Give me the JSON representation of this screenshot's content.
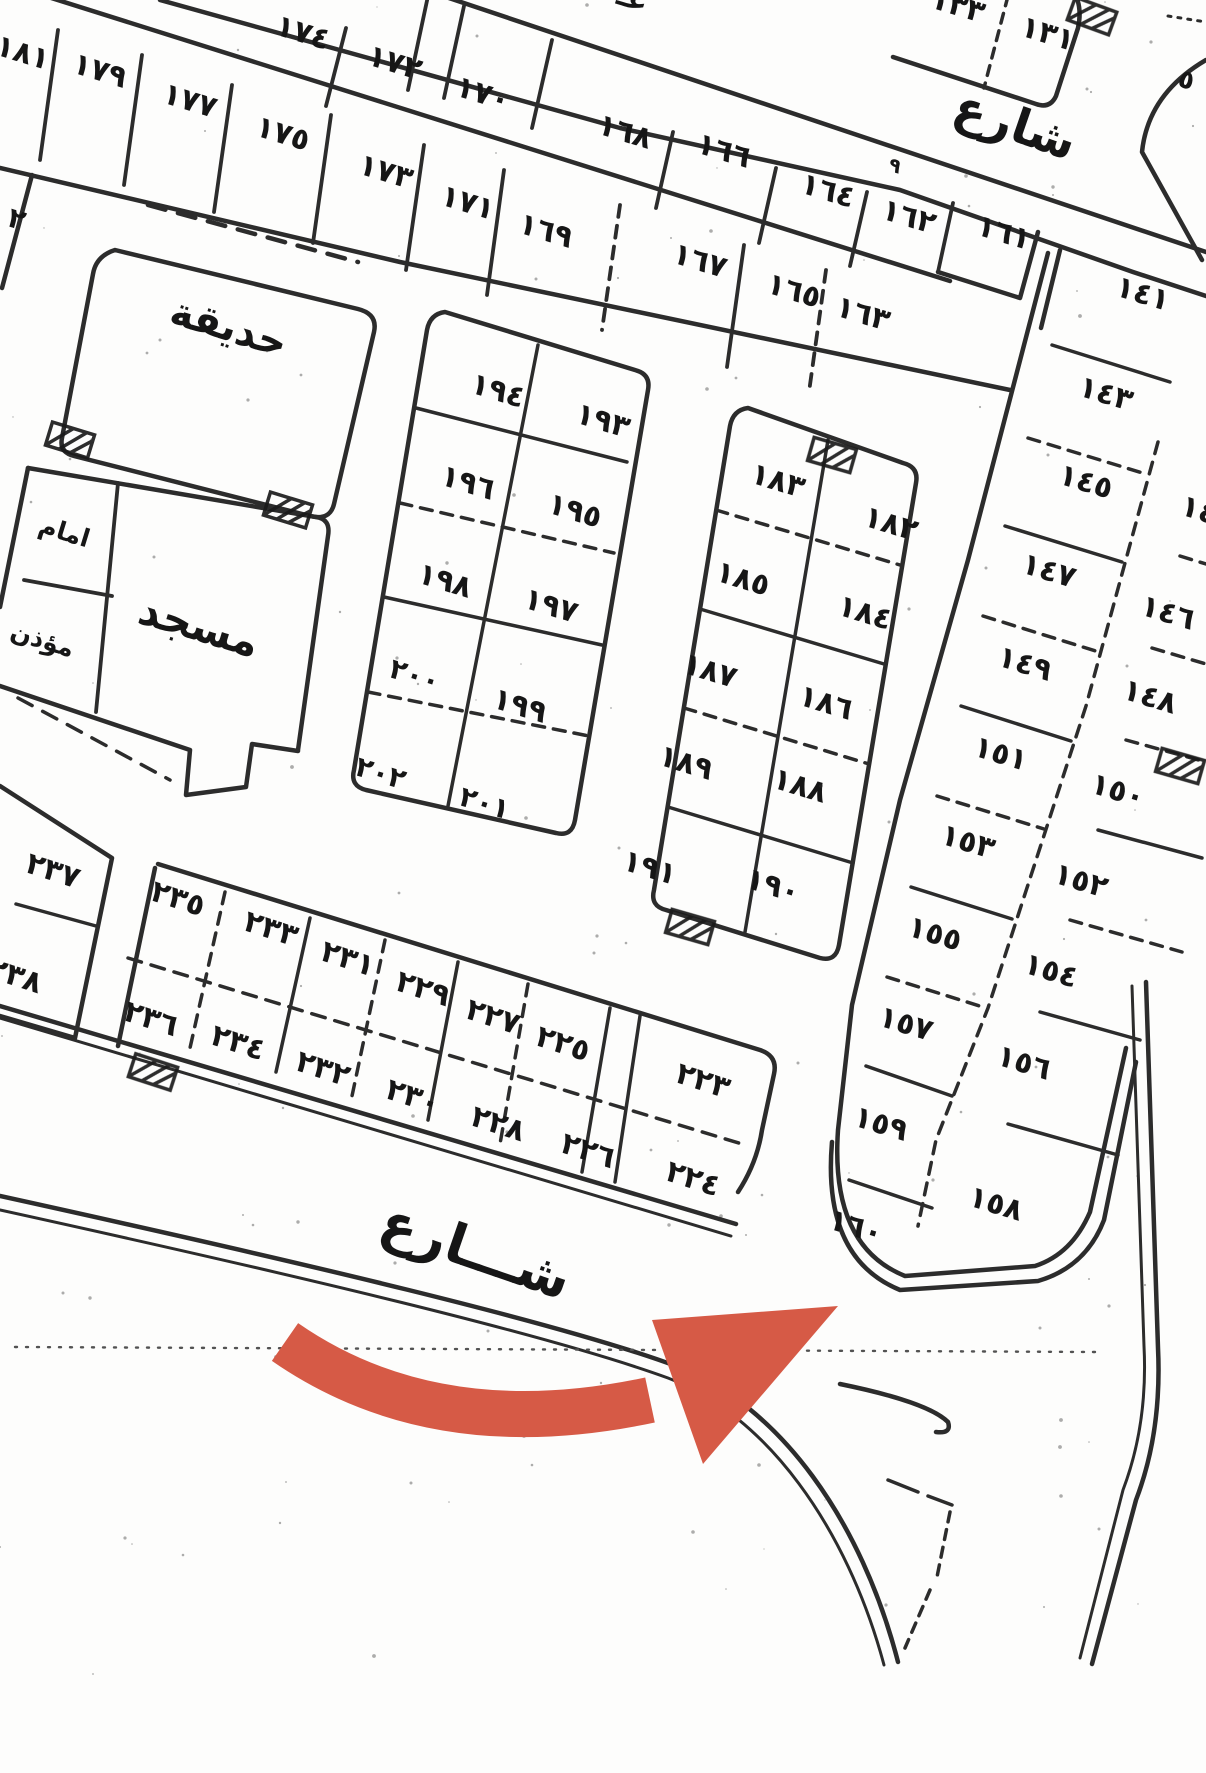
{
  "map": {
    "type": "scanned cadastral subdivision plan (Arabic)",
    "ink_color": "#1b1b1b",
    "paper_color": "#fdfdfc",
    "arrow": {
      "color": "#d65a46",
      "meaning": "annotation-arrow pointing to corner plot ١٦٠"
    },
    "region_labels": {
      "garden": "حديقة",
      "mosque": "مسجد",
      "imam_room": "امام",
      "muezzin_room": "مؤذن"
    },
    "street_word": "شارع",
    "labels": [
      {
        "t": "١٧٤",
        "x": 300,
        "y": 42,
        "n": "plot-174"
      },
      {
        "t": "١٧٢",
        "x": 392,
        "y": 72,
        "n": "plot-172"
      },
      {
        "t": "١٧٠",
        "x": 480,
        "y": 103,
        "n": "plot-170"
      },
      {
        "t": "١٦٨",
        "x": 622,
        "y": 141,
        "n": "plot-168"
      },
      {
        "t": "١٦٦",
        "x": 721,
        "y": 160,
        "n": "plot-166"
      },
      {
        "t": "١٦٤",
        "x": 825,
        "y": 200,
        "n": "plot-164"
      },
      {
        "t": "١٦٢",
        "x": 906,
        "y": 226,
        "n": "plot-162"
      },
      {
        "t": "١٦١",
        "x": 1001,
        "y": 242,
        "n": "plot-161"
      },
      {
        "t": "١٨١",
        "x": 20,
        "y": 62,
        "n": "plot-181"
      },
      {
        "t": "١٧٩",
        "x": 97,
        "y": 80,
        "n": "plot-179"
      },
      {
        "t": "١٧٧",
        "x": 187,
        "y": 110,
        "n": "plot-177"
      },
      {
        "t": "١٧٥",
        "x": 280,
        "y": 143,
        "n": "plot-175"
      },
      {
        "t": "١٧٣",
        "x": 383,
        "y": 181,
        "n": "plot-173"
      },
      {
        "t": "١٧١",
        "x": 465,
        "y": 212,
        "n": "plot-171"
      },
      {
        "t": "١٦٩",
        "x": 543,
        "y": 240,
        "n": "plot-169"
      },
      {
        "t": "١٦٧",
        "x": 697,
        "y": 270,
        "n": "plot-167"
      },
      {
        "t": "١٦٥",
        "x": 791,
        "y": 300,
        "n": "plot-165"
      },
      {
        "t": "١٦٣",
        "x": 860,
        "y": 323,
        "n": "plot-163"
      },
      {
        "t": "١٣٣",
        "x": 955,
        "y": 15,
        "n": "plot-133"
      },
      {
        "t": "١٣١",
        "x": 1045,
        "y": 43,
        "n": "plot-131"
      },
      {
        "t": "١٩٤",
        "x": 495,
        "y": 400,
        "n": "plot-194"
      },
      {
        "t": "١٩٦",
        "x": 465,
        "y": 492,
        "n": "plot-196"
      },
      {
        "t": "١٩٨",
        "x": 442,
        "y": 590,
        "n": "plot-198"
      },
      {
        "t": "٢٠٠",
        "x": 412,
        "y": 684,
        "s": 28,
        "n": "plot-200"
      },
      {
        "t": "٢٠٢",
        "x": 378,
        "y": 782,
        "s": 28,
        "n": "plot-202"
      },
      {
        "t": "١٩٣",
        "x": 600,
        "y": 430,
        "n": "plot-193"
      },
      {
        "t": "١٩٥",
        "x": 572,
        "y": 520,
        "n": "plot-195"
      },
      {
        "t": "١٩٧",
        "x": 548,
        "y": 615,
        "n": "plot-197"
      },
      {
        "t": "١٩٩",
        "x": 517,
        "y": 715,
        "n": "plot-199"
      },
      {
        "t": "٢٠١",
        "x": 482,
        "y": 812,
        "s": 28,
        "n": "plot-201"
      },
      {
        "t": "١٨٣",
        "x": 775,
        "y": 490,
        "n": "plot-183"
      },
      {
        "t": "١٨٥",
        "x": 740,
        "y": 588,
        "n": "plot-185"
      },
      {
        "t": "١٨٧",
        "x": 707,
        "y": 680,
        "n": "plot-187"
      },
      {
        "t": "١٨٩",
        "x": 683,
        "y": 772,
        "n": "plot-189"
      },
      {
        "t": "١٩١",
        "x": 647,
        "y": 877,
        "n": "plot-191"
      },
      {
        "t": "١٨٢",
        "x": 888,
        "y": 533,
        "n": "plot-182"
      },
      {
        "t": "١٨٤",
        "x": 862,
        "y": 622,
        "n": "plot-184"
      },
      {
        "t": "١٨٦",
        "x": 823,
        "y": 712,
        "n": "plot-186"
      },
      {
        "t": "١٨٨",
        "x": 797,
        "y": 795,
        "n": "plot-188"
      },
      {
        "t": "١٩٠",
        "x": 770,
        "y": 895,
        "n": "plot-190"
      },
      {
        "t": "١٤١",
        "x": 1140,
        "y": 303,
        "n": "plot-141"
      },
      {
        "t": "١٤٣",
        "x": 1103,
        "y": 403,
        "n": "plot-143"
      },
      {
        "t": "١٤٥",
        "x": 1083,
        "y": 491,
        "n": "plot-145"
      },
      {
        "t": "١٤٧",
        "x": 1046,
        "y": 580,
        "n": "plot-147"
      },
      {
        "t": "١٤٩",
        "x": 1022,
        "y": 673,
        "n": "plot-149"
      },
      {
        "t": "١٥١",
        "x": 998,
        "y": 763,
        "n": "plot-151"
      },
      {
        "t": "١٥٣",
        "x": 965,
        "y": 851,
        "n": "plot-153"
      },
      {
        "t": "١٥٥",
        "x": 932,
        "y": 943,
        "n": "plot-155"
      },
      {
        "t": "١٥٧",
        "x": 903,
        "y": 1033,
        "n": "plot-157"
      },
      {
        "t": "١٥٩",
        "x": 878,
        "y": 1133,
        "n": "plot-159"
      },
      {
        "t": "١٦٠",
        "x": 853,
        "y": 1236,
        "n": "plot-160"
      },
      {
        "t": "١٤٤",
        "x": 1205,
        "y": 522,
        "n": "plot-144-fragment"
      },
      {
        "t": "١٤٦",
        "x": 1165,
        "y": 622,
        "n": "plot-146"
      },
      {
        "t": "١٤٨",
        "x": 1147,
        "y": 706,
        "n": "plot-148"
      },
      {
        "t": "١٥٠",
        "x": 1115,
        "y": 800,
        "n": "plot-150"
      },
      {
        "t": "١٥٢",
        "x": 1078,
        "y": 890,
        "n": "plot-152"
      },
      {
        "t": "١٥٤",
        "x": 1048,
        "y": 980,
        "n": "plot-154"
      },
      {
        "t": "١٥٦",
        "x": 1021,
        "y": 1072,
        "n": "plot-156"
      },
      {
        "t": "١٥٨",
        "x": 993,
        "y": 1213,
        "n": "plot-158"
      },
      {
        "t": "٢٣٥",
        "x": 175,
        "y": 908,
        "r": 18,
        "n": "plot-235"
      },
      {
        "t": "٢٣٣",
        "x": 268,
        "y": 938,
        "r": 18,
        "n": "plot-233"
      },
      {
        "t": "٢٣١",
        "x": 345,
        "y": 968,
        "r": 18,
        "n": "plot-231"
      },
      {
        "t": "٢٢٩",
        "x": 420,
        "y": 998,
        "r": 18,
        "n": "plot-229"
      },
      {
        "t": "٢٢٧",
        "x": 490,
        "y": 1026,
        "r": 18,
        "n": "plot-227"
      },
      {
        "t": "٢٢٥",
        "x": 560,
        "y": 1053,
        "r": 18,
        "n": "plot-225"
      },
      {
        "t": "٢٢٣",
        "x": 700,
        "y": 1090,
        "r": 18,
        "n": "plot-223"
      },
      {
        "t": "٢٣٦",
        "x": 148,
        "y": 1028,
        "r": 18,
        "n": "plot-236"
      },
      {
        "t": "٢٣٤",
        "x": 235,
        "y": 1052,
        "r": 18,
        "n": "plot-234"
      },
      {
        "t": "٢٣٢",
        "x": 320,
        "y": 1078,
        "r": 18,
        "n": "plot-232"
      },
      {
        "t": "٢٣٠",
        "x": 410,
        "y": 1106,
        "r": 18,
        "n": "plot-230"
      },
      {
        "t": "٢٢٨",
        "x": 495,
        "y": 1133,
        "r": 18,
        "n": "plot-228"
      },
      {
        "t": "٢٢٦",
        "x": 585,
        "y": 1160,
        "r": 18,
        "n": "plot-226"
      },
      {
        "t": "٢٢٤",
        "x": 690,
        "y": 1188,
        "r": 18,
        "n": "plot-224"
      },
      {
        "t": "٢٣٧",
        "x": 50,
        "y": 880,
        "r": 18,
        "n": "plot-237"
      },
      {
        "t": "٢٣٨",
        "x": 12,
        "y": 985,
        "r": 18,
        "n": "plot-238-fragment"
      },
      {
        "t": "٢",
        "x": 14,
        "y": 228,
        "s": 28,
        "n": "fragment-2"
      },
      {
        "t": "٩",
        "x": 893,
        "y": 172,
        "s": 20,
        "n": "fragment-9"
      },
      {
        "t": "٥",
        "x": 1184,
        "y": 88,
        "s": 26,
        "n": "fragment-5"
      },
      {
        "t": "عـ",
        "x": 630,
        "y": 8,
        "s": 30,
        "n": "fragment-street-word"
      },
      {
        "t": "حديقة",
        "x": 225,
        "y": 340,
        "s": 40,
        "n": "garden-label"
      },
      {
        "t": "مسجد",
        "x": 195,
        "y": 640,
        "s": 42,
        "n": "mosque-label"
      },
      {
        "t": "امام",
        "x": 62,
        "y": 540,
        "s": 25,
        "n": "imam-room-label"
      },
      {
        "t": "مؤذن",
        "x": 40,
        "y": 648,
        "s": 25,
        "n": "muezzin-room-label"
      },
      {
        "t": "شارع",
        "x": 1010,
        "y": 140,
        "r": 19,
        "s": 48,
        "n": "street-label-top"
      },
      {
        "t": "شـــارع",
        "x": 470,
        "y": 1268,
        "r": 19,
        "s": 54,
        "n": "street-label-bottom"
      }
    ]
  }
}
